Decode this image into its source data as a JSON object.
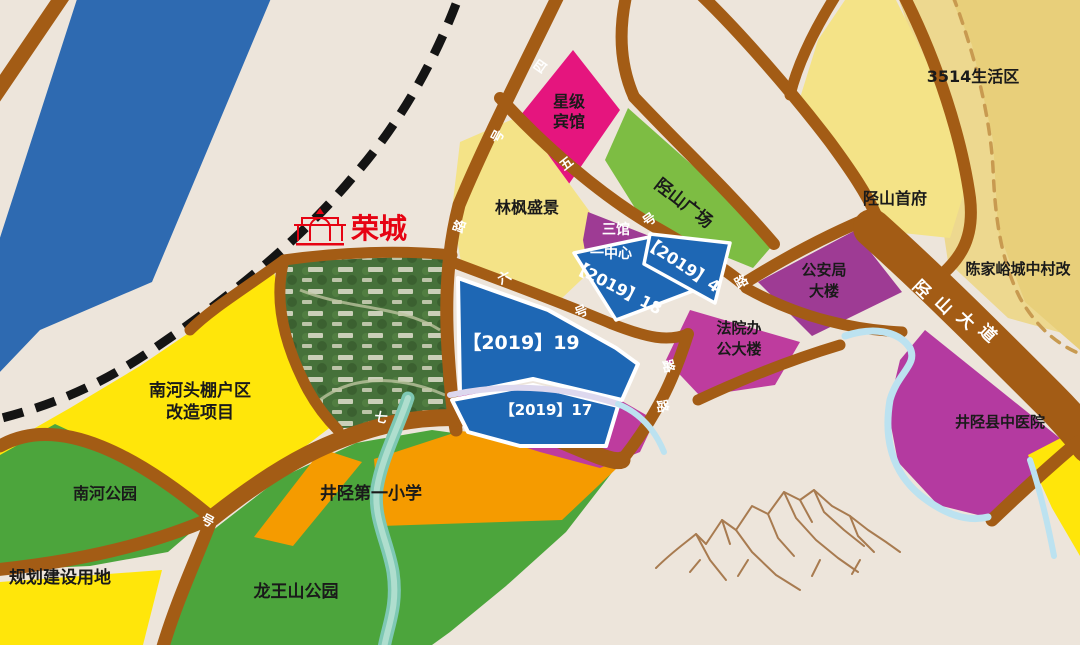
{
  "canvas": {
    "width": 1080,
    "height": 645
  },
  "colors": {
    "background": "#EDE5DB",
    "road": "#A35C15",
    "railway": "#141414",
    "river": "#2E6AB1",
    "yellow_bright": "#FFE60A",
    "yellow_pale": "#F4E387",
    "green_park": "#4CA53C",
    "green_plaza": "#7DBD43",
    "orange": "#F59B00",
    "pink_hotel": "#E5157E",
    "purple": "#9E3B94",
    "magenta": "#BE3C9E",
    "magenta_hospital": "#B43AA0",
    "blue_parcel": "#1E67B4",
    "tan_light": "#EDD88F",
    "tan_dark": "#E8CF7A",
    "tan_dash": "#C89A50",
    "aerial_green": "#46713A",
    "stream_blue": "#BCE2F0",
    "stream_teal_outer": "#7EC8B4",
    "stream_teal_inner": "#AFDECE",
    "divider_white": "#DDD8EE",
    "mountain": "#A87B50",
    "logo_red": "#E60313"
  },
  "logo": {
    "name": "荣城"
  },
  "parcels": {
    "nanhetou": {
      "line1": "南河头棚户区",
      "line2": "改造项目"
    },
    "nanhe_park": {
      "label": "南河公园"
    },
    "guihua": {
      "label": "规划建设用地"
    },
    "longwangshan": {
      "label": "龙王山公园"
    },
    "primary_school": {
      "label": "井陉第一小学"
    },
    "linfeng": {
      "label": "林枫盛景"
    },
    "hotel": {
      "line1": "星级",
      "line2": "宾馆"
    },
    "sanguan": {
      "line1": "三馆",
      "line2": "一中心"
    },
    "plaza": {
      "label": "陉山广场"
    },
    "shoufu": {
      "label": "陉山首府"
    },
    "shenghuoqu": {
      "label": "3514生活区"
    },
    "chenjiayu": {
      "label": "陈家峪城中村改"
    },
    "gonganju": {
      "line1": "公安局",
      "line2": "大楼"
    },
    "fayuan": {
      "line1": "法院办",
      "line2": "公大楼"
    },
    "hospital": {
      "label": "井陉县中医院"
    },
    "parcel19": {
      "label": "【2019】19"
    },
    "parcel17": {
      "label": "【2019】17"
    },
    "parcel18": {
      "label": "【2019】18"
    },
    "parcel4": {
      "label": "【2019】4"
    }
  },
  "avenue": {
    "label": "陉山大道",
    "chars": [
      {
        "c": "陉"
      },
      {
        "c": "山"
      },
      {
        "c": "大"
      },
      {
        "c": "道"
      }
    ]
  },
  "road_chars": [
    {
      "c": "四"
    },
    {
      "c": "号"
    },
    {
      "c": "路"
    },
    {
      "c": "五"
    },
    {
      "c": "号"
    },
    {
      "c": "路"
    },
    {
      "c": "六"
    },
    {
      "c": "号"
    },
    {
      "c": "路"
    },
    {
      "c": "路"
    },
    {
      "c": "七"
    },
    {
      "c": "号"
    }
  ]
}
